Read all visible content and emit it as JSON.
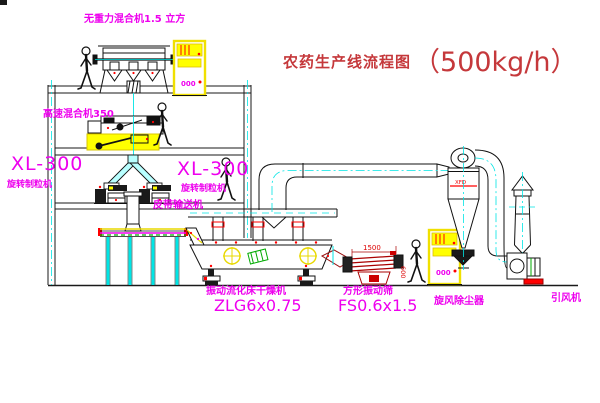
{
  "title": {
    "name": "农药生产线流程图",
    "capacity": "（500kg/h）"
  },
  "equipment": {
    "gravity_mixer": {
      "label": "无重力混合机1.5 立方"
    },
    "high_speed_mixer": {
      "label": "高速混合机350"
    },
    "granulator_left": {
      "model": "XL-300",
      "label": "旋转制粒机"
    },
    "granulator_right": {
      "model": "XL-300",
      "label": "旋转制粒机"
    },
    "belt_conveyor": {
      "label": "皮带输送机"
    },
    "fluid_bed_dryer": {
      "label": "振动流化床干燥机",
      "model": "ZLG6x0.75"
    },
    "vibrating_screen": {
      "label": "方形振动筛",
      "model": "FS0.6x1.5"
    },
    "cyclone": {
      "label": "旋风除尘器",
      "tag": "XFD"
    },
    "fan": {
      "label": "引风机"
    }
  },
  "annotations": {
    "cabinet1": "000",
    "cabinet2": "000",
    "dim_length": "1500",
    "dim_height": "600"
  },
  "colors": {
    "label_magenta": "#ee00ee",
    "title_red": "#c5383b",
    "highlight_yellow": "#ffff00",
    "centerline_cyan": "#00e5e5",
    "detail_red": "#ff0000",
    "detail_green": "#00aa00",
    "line_black": "#1a1a1a"
  }
}
